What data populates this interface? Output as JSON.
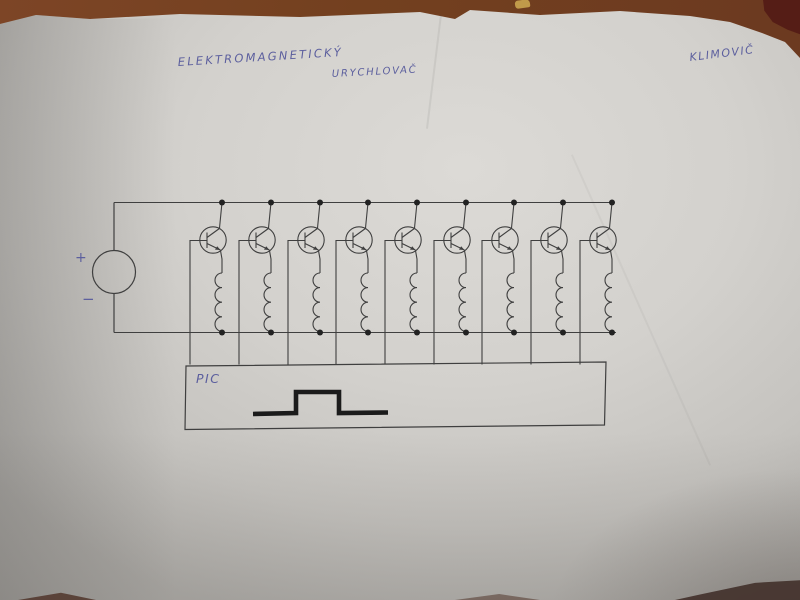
{
  "photo_meta": {
    "description": "photograph of a hand-drawn circuit schematic on white paper lying on a brown table",
    "colors": {
      "table_brown": "#7d4526",
      "paper_light": "#dcdad6",
      "ink_blue": "#5c5f9e",
      "pencil_line": "#3f3f3f",
      "pulse_black": "#1b1b1b",
      "red_object": "#551d16",
      "crumb_yellow": "#c09a4a"
    }
  },
  "annotations": {
    "title_line1": "ELEKTROMAGNETICKÝ",
    "title_line2": "URYCHLOVAČ",
    "author": "KLIMOVIČ",
    "source_plus": "+",
    "source_minus": "−",
    "controller_label": "PIC"
  },
  "circuit": {
    "stage_count": 9,
    "stage_xs": [
      222,
      271,
      320,
      368,
      417,
      466,
      514,
      563,
      612
    ],
    "top_rail_y": 202.5,
    "bottom_rail_y": 332.5,
    "power_source": {
      "center_x": 114,
      "center_y": 272,
      "radius": 21.5
    },
    "controller_box": {
      "left": 186,
      "top": 365,
      "right": 606,
      "bottom": 427
    },
    "waveform": "single rectangular positive pulse, low-high-low",
    "components": "DC source feeding 9 parallel NPN transistor + coil driver stages; transistor bases driven from PIC box"
  }
}
